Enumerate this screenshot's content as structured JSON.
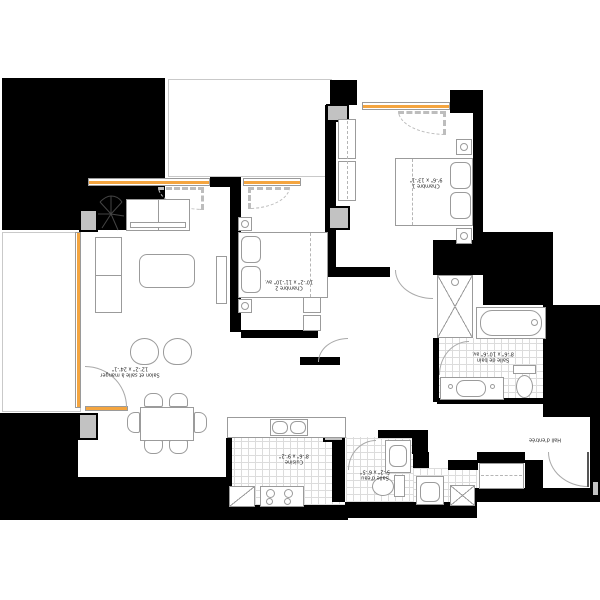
{
  "plan": {
    "title": "apartment-floor-plan",
    "label_rotation_deg": 180,
    "rooms": {
      "chambre1": {
        "name": "Chambre 1",
        "dims": "9'-6\" x 13'-1\""
      },
      "chambre2": {
        "name": "Chambre 2",
        "dims": "10'-2\" x 11'-10\" av."
      },
      "salon": {
        "name": "Salon et salle à manger",
        "dims": "12'-2\" x 24'-1\""
      },
      "cuisine": {
        "name": "Cuisine",
        "dims": "8'-6\" x 9'-2\""
      },
      "salle_de_bain": {
        "name": "Salle de bain",
        "dims": "8'-6\" x 10'-6\" av."
      },
      "salle_eau": {
        "name": "Salle d'eau",
        "dims": "5'-2\" x 6'-5\""
      },
      "hall": {
        "name": "Hall d'entrée",
        "dims": ""
      }
    },
    "colors": {
      "wall": "#000000",
      "column": "#c2c2c2",
      "window_accent": "#f4a540",
      "furniture_line": "#9b9b9b"
    }
  }
}
